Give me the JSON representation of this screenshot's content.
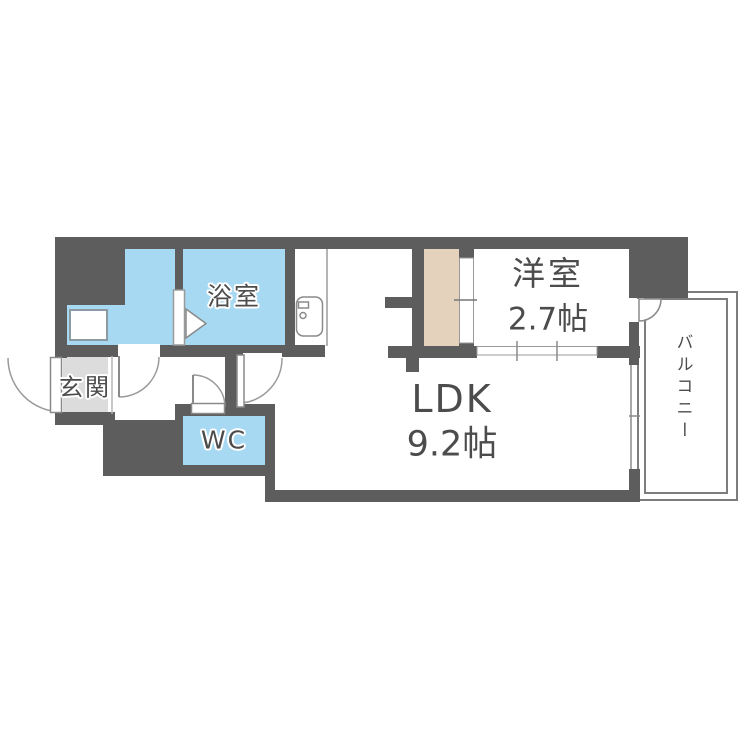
{
  "plan": {
    "type": "apartment-floor-plan",
    "rooms": {
      "entrance": {
        "label": "玄関"
      },
      "bathroom": {
        "label": "浴室"
      },
      "wc": {
        "label": "WC"
      },
      "ldk": {
        "label": "LDK",
        "area": "9.2帖"
      },
      "western_room": {
        "label": "洋室",
        "area": "2.7帖"
      },
      "balcony": {
        "label": "バルコニー"
      }
    },
    "icons": [
      "kitchen-sink-icon",
      "washing-machine-pan-icon",
      "door-swing-arc-icon",
      "folding-door-triangle-icon",
      "sliding-door-icon"
    ],
    "colors": {
      "wall": "#5d5d5d",
      "water_rooms": "#a8d9f2",
      "closet": "#e4d2bc",
      "entrance_tile": "#dcdcdc",
      "balcony_line": "#7d7d7d",
      "label_text": "#4c4c4c",
      "linework": "#8a8a8a"
    }
  }
}
